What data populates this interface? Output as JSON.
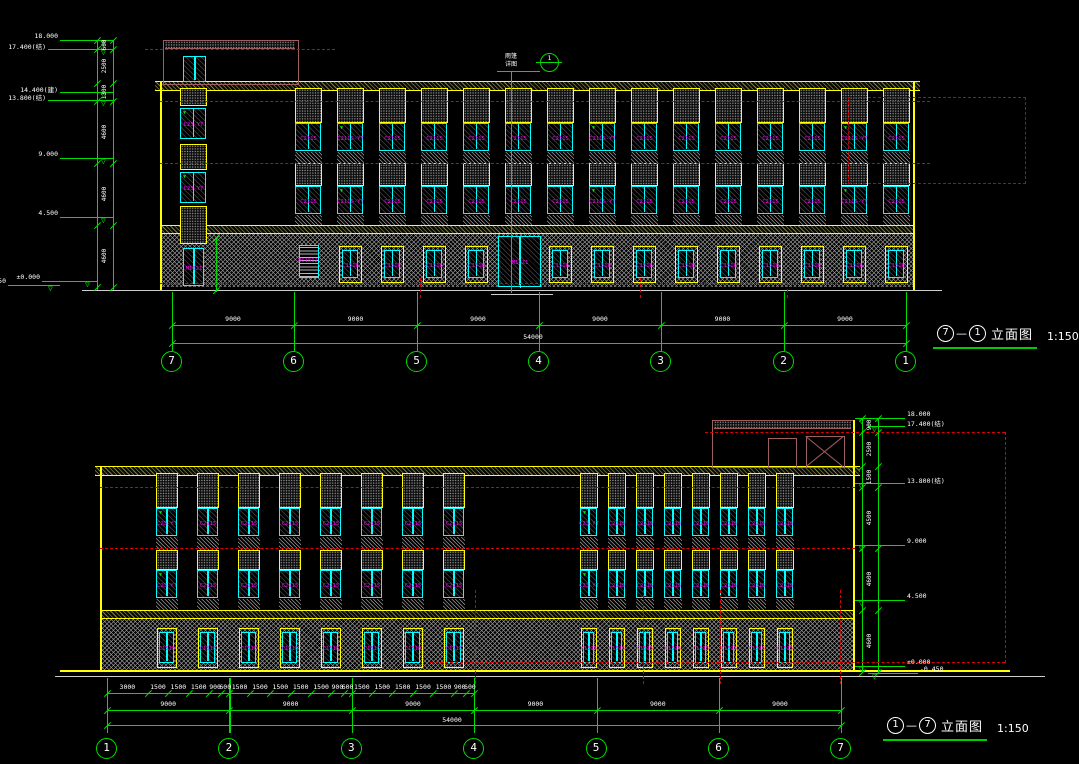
{
  "drawing": {
    "background": "#000000",
    "colors": {
      "dim_green": "#00dd00",
      "outline_yellow": "#ffff00",
      "window_cyan": "#00ffff",
      "tag_magenta": "#ff00ff",
      "axis_red": "#dd0000",
      "text_white": "#ffffff",
      "penthouse_brown": "#a05f5f",
      "hatch_gray": "#9a9a9a"
    },
    "views": {
      "top": {
        "title": {
          "from": "7",
          "sep": "—",
          "to": "1",
          "name": "立面图",
          "scale": "1:150"
        },
        "grids": [
          "7",
          "6",
          "5",
          "4",
          "3",
          "2",
          "1"
        ],
        "bay_dims": [
          "9000",
          "9000",
          "9000",
          "9000",
          "9000",
          "9000"
        ],
        "total_dim": "54000",
        "levels": [
          "18.000",
          "17.400(结)",
          "14.400(建)",
          "13.800(结)",
          "9.000",
          "4.500",
          "±0.000",
          "-0.450"
        ],
        "chain_dims": [
          "600",
          "2500",
          "1300",
          "4600",
          "4600",
          "4600"
        ],
        "annotation": {
          "line1": "雨篷",
          "line2": "详图",
          "bubble": "1"
        },
        "tags": {
          "upper": "C2115",
          "upper_vt": "C2115-YT",
          "ground": "C1518",
          "louver": "BC1512",
          "stair": "C23-YT",
          "side_door": "M1021",
          "entrance": "M1821"
        }
      },
      "bottom": {
        "title": {
          "from": "1",
          "sep": "—",
          "to": "7",
          "name": "立面图",
          "scale": "1:150"
        },
        "grids": [
          "1",
          "2",
          "3",
          "4",
          "5",
          "6",
          "7"
        ],
        "bay_dims": [
          "9000",
          "9000",
          "9000",
          "9000",
          "9000",
          "9000"
        ],
        "total_dim": "54000",
        "sub_dims": [
          [
            "3000",
            "1500",
            "1500",
            "1500",
            "900",
            "600"
          ],
          [
            "1500",
            "1500",
            "1500",
            "1500",
            "1500",
            "900",
            "600"
          ],
          [
            "1500",
            "1500",
            "1500",
            "1500",
            "1500",
            "900",
            "600"
          ]
        ],
        "levels": [
          "18.000",
          "17.400(结)",
          "13.800(结)",
          "9.000",
          "4.500",
          "±0.000",
          "-0.450"
        ],
        "chain_dims": [
          "900",
          "2500",
          "1500",
          "4500",
          "4600",
          "4600"
        ],
        "tags": {
          "upper": "C2115",
          "ground": "C1515",
          "stair": "C23-YT"
        }
      }
    }
  }
}
